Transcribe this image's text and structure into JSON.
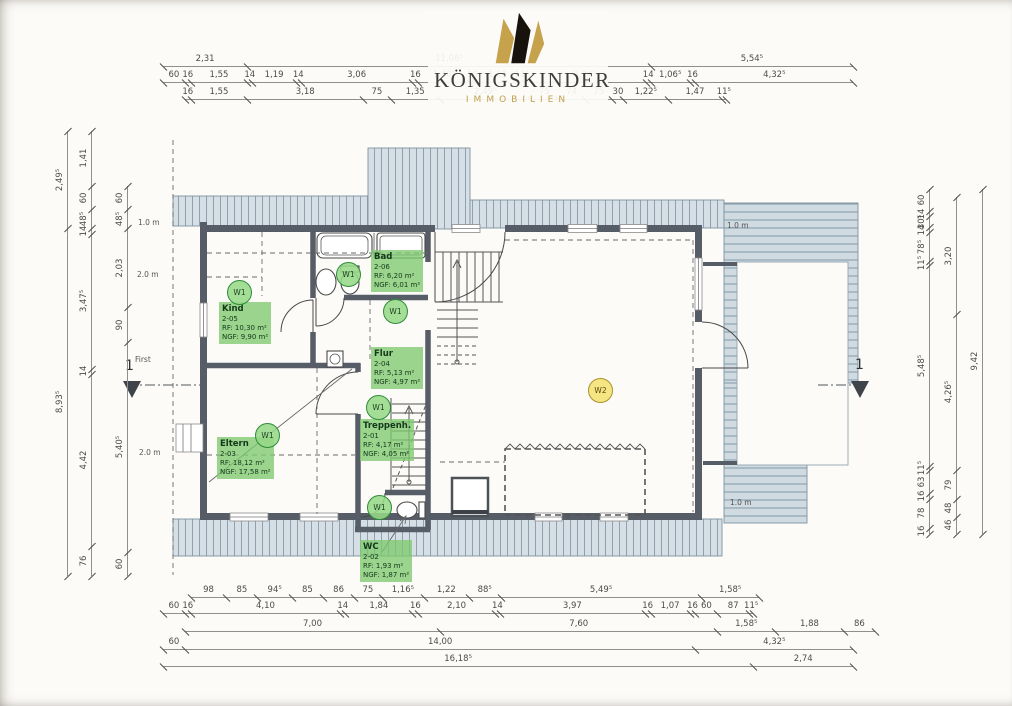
{
  "logo": {
    "brand": "KÖNIGSKINDER",
    "tagline": "IMMOBILIEN"
  },
  "plan": {
    "rooms": {
      "kind": {
        "name": "Kind",
        "id": "2-05",
        "rf": "RF:   10,30 m²",
        "ngf": "NGF: 9,90 m²"
      },
      "bad": {
        "name": "Bad",
        "id": "2-06",
        "rf": "RF:   6,20 m²",
        "ngf": "NGF: 6,01 m²"
      },
      "flur": {
        "name": "Flur",
        "id": "2-04",
        "rf": "RF:   5,13 m²",
        "ngf": "NGF: 4,97 m²"
      },
      "eltern": {
        "name": "Eltern",
        "id": "2-03",
        "rf": "RF:   18,12 m²",
        "ngf": "NGF: 17,58 m²"
      },
      "treppenhaus": {
        "name": "Treppenh.",
        "id": "2-01",
        "rf": "RF:   4,17 m²",
        "ngf": "NGF: 4,05 m²"
      },
      "wc": {
        "name": "WC",
        "id": "2-02",
        "rf": "RF:   1,93 m²",
        "ngf": "NGF: 1,87 m²"
      }
    },
    "unit_markers": {
      "w1": "W1",
      "w2": "W2"
    },
    "annotations": {
      "ridge": "First",
      "section": "1",
      "height_1m": "1.0 m",
      "height_2m": "2.0 m"
    }
  },
  "dimensions": {
    "top_a": [
      "2,31",
      "11,06⁵",
      "5,54⁵"
    ],
    "top_b": [
      "60",
      "16",
      "1,55",
      "14",
      "1,19",
      "14",
      "3,06",
      "16",
      "1,40⁵",
      "16",
      "1,21",
      "11⁵",
      "3,34⁵",
      "14",
      "1,06⁵",
      "16",
      "4,32⁵"
    ],
    "top_c": [
      "16",
      "1,55",
      "3,18",
      "75",
      "1,35",
      "2,49⁵",
      "75",
      "74",
      "75",
      "30",
      "1,22⁵",
      "1,47",
      "11⁵"
    ],
    "bottom_1": [
      "98",
      "85",
      "94⁵",
      "85",
      "86",
      "75",
      "1,16⁵",
      "1,22",
      "88⁵",
      "5,49⁵",
      "1,58⁵"
    ],
    "bottom_2": [
      "60",
      "16",
      "4,10",
      "14",
      "1,84",
      "16",
      "2,10",
      "14",
      "3,97",
      "16",
      "1,07",
      "16",
      "60",
      "87",
      "11⁵"
    ],
    "bottom_3": [
      "7,00",
      "7,60",
      "1,58⁵",
      "1,88",
      "86"
    ],
    "bottom_4": [
      "60",
      "14,00",
      "4,32⁵"
    ],
    "bottom_5": [
      "16,18⁵",
      "2,74"
    ],
    "left_outer": [
      "2,49⁵",
      "8,93⁵"
    ],
    "left_mid": [
      "1,41",
      "60",
      "48⁵",
      "14",
      "3,47⁵",
      "14",
      "4,42",
      "76"
    ],
    "left_inner": [
      "60",
      "48⁵",
      "2,03",
      "90",
      "5,40⁵",
      "60"
    ],
    "right_inner": [
      "60",
      "14",
      "30⁵",
      "14",
      "78⁵",
      "11⁵",
      "5,48⁵",
      "11⁵",
      "63",
      "16",
      "78",
      "16"
    ],
    "right_mid": [
      "3,20",
      "4,26⁵",
      "79",
      "48",
      "46"
    ],
    "right_outer": [
      "9,42"
    ]
  },
  "colors": {
    "roof_hatch": "#d6dfe5",
    "wall": "#565d66",
    "room_label_green": "#7dc96e",
    "marker_w1": "#96d887",
    "marker_w2": "#f6e47c",
    "logo_gold": "#c2a14e"
  }
}
